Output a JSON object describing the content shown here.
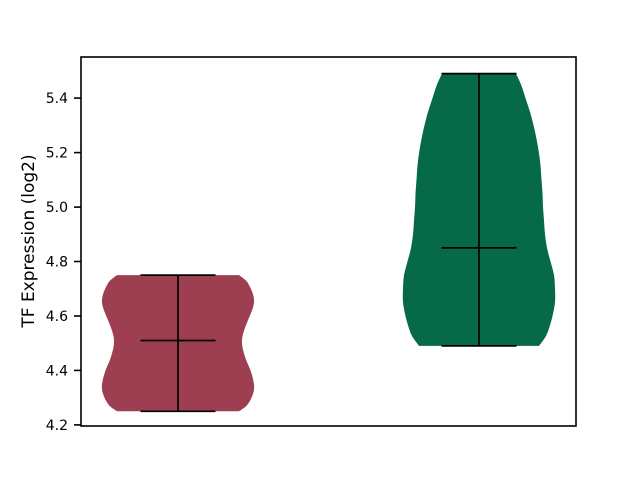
{
  "figure": {
    "background": "#ffffff",
    "title": ""
  },
  "chart_data": {
    "type": "violin",
    "title": "",
    "xlabel": "",
    "ylabel": "TF Expression (log2)",
    "ylim": [
      4.196,
      5.551
    ],
    "yticks": [
      4.2,
      4.4,
      4.6,
      4.8,
      5.0,
      5.2,
      5.4
    ],
    "ytick_labels": [
      "4.2",
      "4.4",
      "4.6",
      "4.8",
      "5.0",
      "5.2",
      "5.4"
    ],
    "xtick_labels": [],
    "grid": false,
    "legend": "none",
    "axis_color": "#000000",
    "inner_line_color": "#000000",
    "series": [
      {
        "name": "violin-left",
        "fill_color": "#9d3f50",
        "min": 4.25,
        "max": 4.75,
        "median": 4.51,
        "profile_value_halfwidth_px": [
          [
            4.25,
            61
          ],
          [
            4.27,
            68.5
          ],
          [
            4.3,
            73.5
          ],
          [
            4.33,
            76
          ],
          [
            4.36,
            75.5
          ],
          [
            4.4,
            72.5
          ],
          [
            4.44,
            68
          ],
          [
            4.48,
            64.8
          ],
          [
            4.51,
            64
          ],
          [
            4.54,
            65.5
          ],
          [
            4.58,
            69.5
          ],
          [
            4.62,
            74
          ],
          [
            4.65,
            76
          ],
          [
            4.68,
            75
          ],
          [
            4.71,
            71.5
          ],
          [
            4.73,
            68
          ],
          [
            4.75,
            61
          ]
        ]
      },
      {
        "name": "violin-right",
        "fill_color": "#066947",
        "min": 4.49,
        "max": 5.49,
        "median": 4.85,
        "profile_value_halfwidth_px": [
          [
            4.49,
            60
          ],
          [
            4.51,
            64
          ],
          [
            4.53,
            67.5
          ],
          [
            4.56,
            70.5
          ],
          [
            4.6,
            73.5
          ],
          [
            4.65,
            76
          ],
          [
            4.7,
            76
          ],
          [
            4.75,
            75
          ],
          [
            4.8,
            71.5
          ],
          [
            4.85,
            68
          ],
          [
            4.9,
            66
          ],
          [
            4.95,
            65
          ],
          [
            5.0,
            64
          ],
          [
            5.05,
            63.5
          ],
          [
            5.1,
            62.5
          ],
          [
            5.17,
            61
          ],
          [
            5.25,
            57.5
          ],
          [
            5.33,
            52.5
          ],
          [
            5.4,
            46.5
          ],
          [
            5.45,
            42
          ],
          [
            5.49,
            37
          ]
        ]
      }
    ]
  }
}
